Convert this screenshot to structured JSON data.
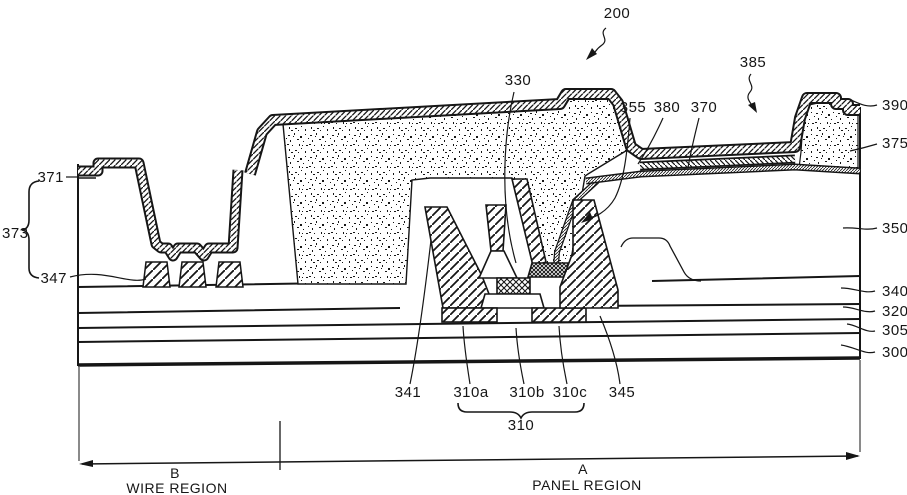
{
  "figure": {
    "kind": "cross-section diagram",
    "main_reference": "200"
  },
  "colors": {
    "ink": "#161616",
    "background": "#ffffff"
  },
  "callouts": {
    "c200": "200",
    "c330": "330",
    "c385": "385",
    "c355": "355",
    "c380": "380",
    "c370": "370",
    "c390": "390",
    "c375": "375",
    "c350": "350",
    "c340": "340",
    "c320": "320",
    "c305": "305",
    "c300": "300",
    "c371": "371",
    "c373": "373",
    "c347": "347",
    "c341": "341",
    "c310a": "310a",
    "c310b": "310b",
    "c310c": "310c",
    "c345": "345",
    "c310": "310"
  },
  "regions": {
    "b_letter": "B",
    "b_title": "WIRE REGION",
    "a_letter": "A",
    "a_title": "PANEL REGION"
  }
}
